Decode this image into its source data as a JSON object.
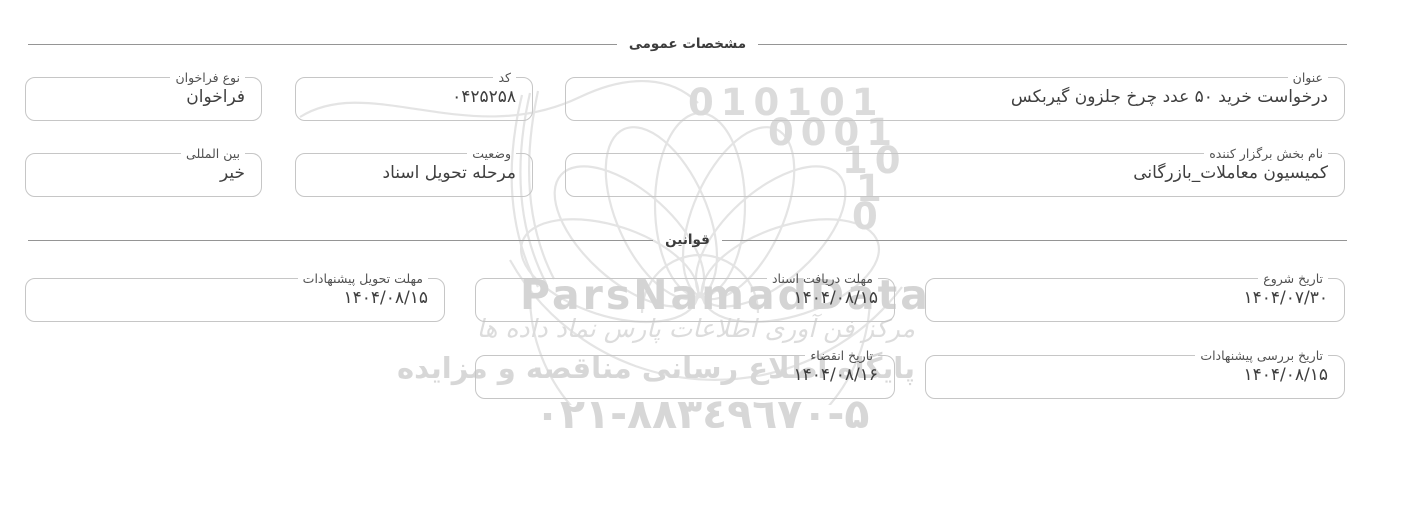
{
  "sections": {
    "general": {
      "title": "مشخصات عمومی"
    },
    "rules": {
      "title": "قوانین"
    }
  },
  "fields": {
    "title": {
      "label": "عنوان",
      "value": "درخواست خرید ۵۰ عدد چرخ جلزون گیربکس"
    },
    "code": {
      "label": "کد",
      "value": "۰۴۲۵۲۵۸"
    },
    "call_type": {
      "label": "نوع فراخوان",
      "value": "فراخوان"
    },
    "organizer": {
      "label": "نام بخش برگزار کننده",
      "value": "کمیسیون معاملات_بازرگانی"
    },
    "status": {
      "label": "وضعیت",
      "value": "مرحله تحویل اسناد"
    },
    "international": {
      "label": "بین المللی",
      "value": "خیر"
    },
    "start_date": {
      "label": "تاریخ شروع",
      "value": "۱۴۰۴/۰۷/۳۰"
    },
    "doc_deadline": {
      "label": "مهلت دریافت اسناد",
      "value": "۱۴۰۴/۰۸/۱۵"
    },
    "proposal_deadline": {
      "label": "مهلت تحویل پیشنهادات",
      "value": "۱۴۰۴/۰۸/۱۵"
    },
    "review_date": {
      "label": "تاریخ بررسی پیشنهادات",
      "value": "۱۴۰۴/۰۸/۱۵"
    },
    "expiry_date": {
      "label": "تاریخ انقضاء",
      "value": "۱۴۰۴/۰۸/۱۶"
    }
  },
  "watermark": {
    "brand": "ParsNamadData",
    "binary_lines": [
      "010101",
      "0001",
      "10",
      "1",
      "0"
    ],
    "calligraphy": "مرکز فن آوری اطلاعات پارس نماد داده ها",
    "tagline": "پایگاه اطلاع رسانی مناقصه و مزایده",
    "phone": "۰۲۱-۸۸۳٤۹٦۷۰-۵",
    "color": "#d9d9d9"
  },
  "colors": {
    "field_border": "#c6c6c6",
    "divider_line": "#959595",
    "value_text": "#3f3f3f",
    "label_text": "#515151",
    "watermark": "#d9d9d9"
  }
}
